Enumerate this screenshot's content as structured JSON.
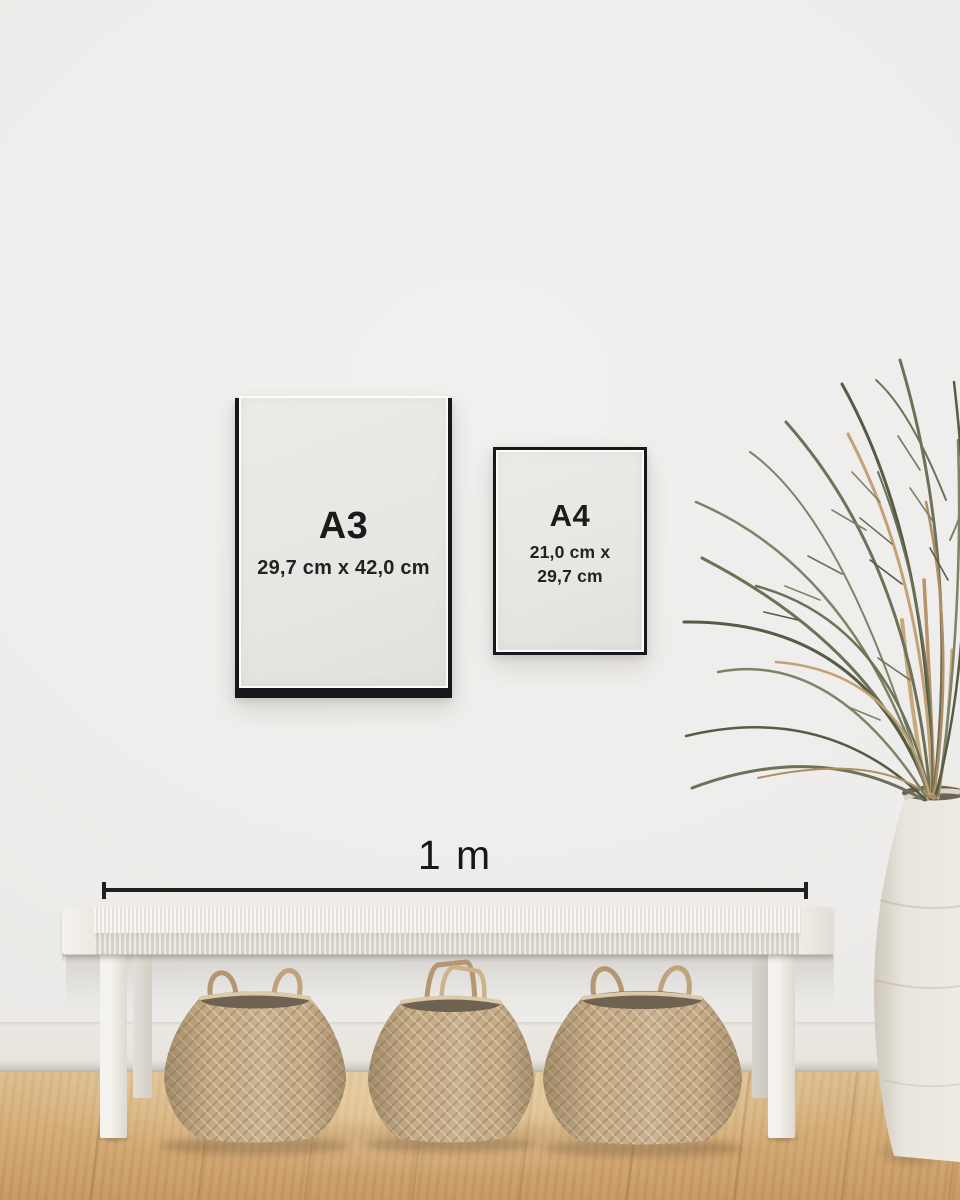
{
  "scene": {
    "description": "Interior wall mockup comparing A3 and A4 poster frame sizes with a 1 m scale bar above a bench",
    "palette": {
      "wall": "#eeedeb",
      "baseboard": "#e8e5e0",
      "floor_wood": "#d2a871",
      "frame_black": "#17181c",
      "frame_paper": "#e9e7e4",
      "scale_line": "#20201f",
      "bench_white": "#f1efe9",
      "basket_weave": "#c6ad8a",
      "vase_white": "#efebe4",
      "leaf_green": "#6b7257",
      "leaf_dry_tan": "#c2a174"
    }
  },
  "frames": {
    "a3": {
      "label": "A3",
      "dimensions": "29,7 cm x 42,0 cm"
    },
    "a4": {
      "label": "A4",
      "dimensions_line1": "21,0 cm x",
      "dimensions_line2": "29,7 cm"
    }
  },
  "scale_bar": {
    "label": "1 m"
  }
}
